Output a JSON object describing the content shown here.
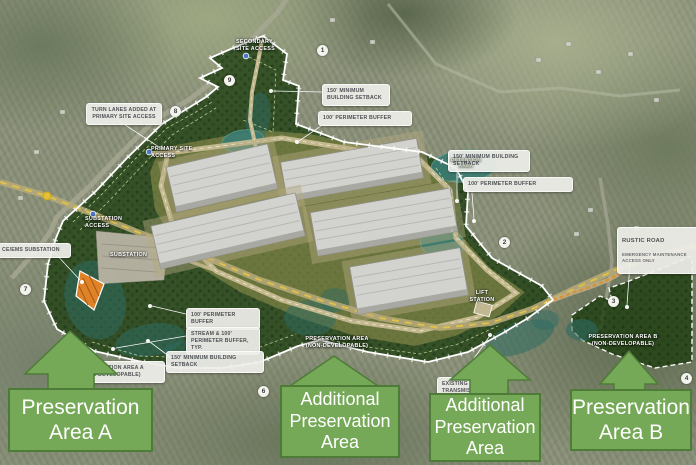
{
  "colors": {
    "arrow_green": "#76a957",
    "arrow_border": "#4e7c38",
    "site_green": "#1f3f12",
    "dev_olive": "#8f8f4e",
    "stream_teal": "#2e6b63",
    "pond_teal": "#3c7d74",
    "road_tan": "#c9bd92",
    "road_dash_yellow": "#e4c443",
    "substation_orange": "#e08227"
  },
  "callouts": {
    "turn_lanes": "TURN LANES ADDED AT\nPRIMARY SITE ACCESS",
    "setback_top": "150' MINIMUM\nBUILDING SETBACK",
    "buffer_top": "100' PERIMETER BUFFER",
    "setback_right": "150' MINIMUM BUILDING\nSETBACK",
    "buffer_right": "100' PERIMETER BUFFER",
    "rustic_title": "RUSTIC ROAD",
    "rustic_sub": "EMERGENCY MAINTENANCE\nACCESS ONLY",
    "ems_substation": "CE/EMS SUBSTATION",
    "buffer_sw": "100' PERIMETER BUFFER",
    "stream_buffer": "STREAM & 100'\nPERIMETER BUFFER, TYP.",
    "setback_sw": "150' MINIMUM BUILDING SETBACK",
    "existing_transmission": "EXISTING\nTRANSMISSION",
    "preservation_a_label": "PRESERVATION AREA A\n(NON-DEVELOPABLE)"
  },
  "map_labels": {
    "secondary_access": "SECONDARY\nSITE ACCESS",
    "primary_access": "PRIMARY SITE\nACCESS",
    "substation_access": "SUBSTATION\nACCESS",
    "substation": "SUBSTATION",
    "lift_station": "LIFT\nSTATION",
    "detention_area": "DETENTION\nAREA",
    "preservation_center": "PRESERVATION AREA\n(NON-DEVELOPABLE)",
    "preservation_b": "PRESERVATION AREA B\n(NON-DEVELOPABLE)"
  },
  "markers": [
    "1",
    "9",
    "8",
    "7",
    "2",
    "3",
    "4",
    "6"
  ],
  "legend": {
    "area_a": "Preservation\nArea A",
    "additional_1": "Additional\nPreservation\nArea",
    "additional_2": "Additional\nPreservation\nArea",
    "area_b": "Preservation\nArea B"
  }
}
